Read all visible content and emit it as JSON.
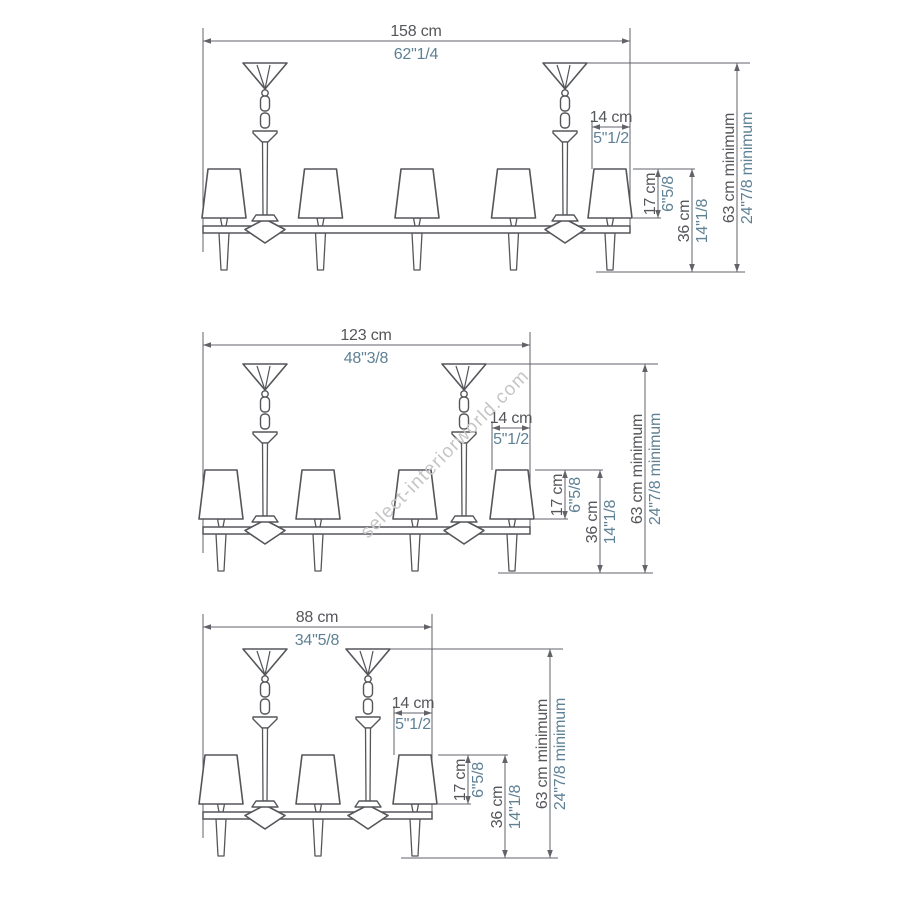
{
  "page": {
    "watermark": "select-interiorworld.com",
    "background": "#ffffff"
  },
  "colors": {
    "line": "#54565a",
    "dimension_line": "#616368",
    "cm_text": "#54565a",
    "inch_text": "#5e8195",
    "watermark": "#c6c6c6"
  },
  "diagrams": [
    {
      "name": "5-light linear chandelier",
      "lights": 5,
      "dimensions": {
        "width": {
          "cm": "158 cm",
          "inches": "62\"1/4"
        },
        "suspension_offset": {
          "cm": "14 cm",
          "inches": "5\"1/2"
        },
        "shade_height": {
          "cm": "17 cm",
          "inches": "6\"5/8"
        },
        "body_height": {
          "cm": "36 cm",
          "inches": "14\"1/8"
        },
        "min_height": {
          "cm": "63 cm minimum",
          "inches": "24\"7/8 minimum"
        }
      }
    },
    {
      "name": "4-light linear chandelier",
      "lights": 4,
      "dimensions": {
        "width": {
          "cm": "123 cm",
          "inches": "48\"3/8"
        },
        "suspension_offset": {
          "cm": "14 cm",
          "inches": "5\"1/2"
        },
        "shade_height": {
          "cm": "17 cm",
          "inches": "6\"5/8"
        },
        "body_height": {
          "cm": "36 cm",
          "inches": "14\"1/8"
        },
        "min_height": {
          "cm": "63 cm minimum",
          "inches": "24\"7/8 minimum"
        }
      }
    },
    {
      "name": "3-light linear chandelier",
      "lights": 3,
      "dimensions": {
        "width": {
          "cm": "88 cm",
          "inches": "34\"5/8"
        },
        "suspension_offset": {
          "cm": "14 cm",
          "inches": "5\"1/2"
        },
        "shade_height": {
          "cm": "17 cm",
          "inches": "6\"5/8"
        },
        "body_height": {
          "cm": "36 cm",
          "inches": "14\"1/8"
        },
        "min_height": {
          "cm": "63 cm minimum",
          "inches": "24\"7/8 minimum"
        }
      }
    }
  ]
}
